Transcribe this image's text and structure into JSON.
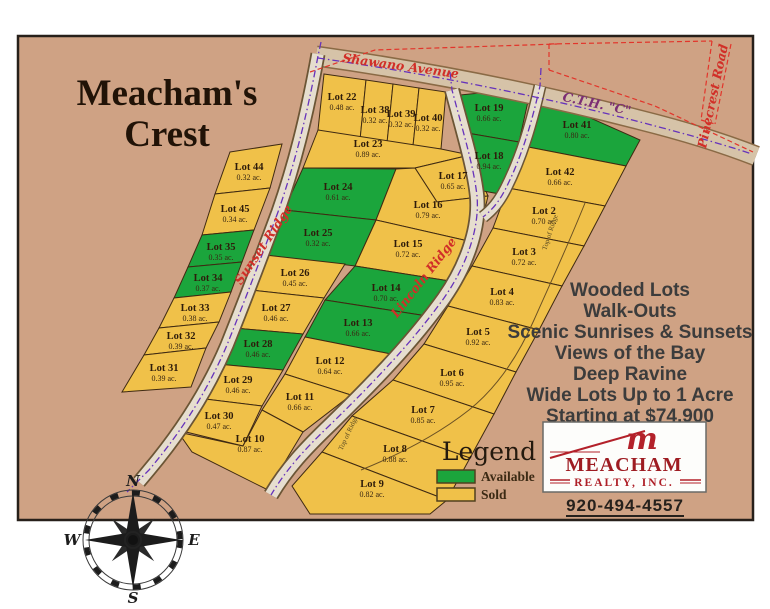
{
  "title": {
    "line1": "Meacham's",
    "line2": "Crest"
  },
  "roads": {
    "shawano": "Shawano Avenue",
    "cth_c": "C.T.H. \"C\"",
    "pinecrest": "Pinecrest Road",
    "sunset": "Sunset Ridge",
    "lincoln": "Lincoln Ridge",
    "top_of_ridge": "Top of Ridge"
  },
  "marketing": {
    "lines": [
      "Wooded Lots",
      "Walk-Outs",
      "Scenic Sunrises & Sunsets",
      "Views of the Bay",
      "Deep Ravine",
      "Wide Lots Up to 1 Acre",
      "Starting at $74,900"
    ]
  },
  "legend": {
    "title": "Legend",
    "items": [
      {
        "label": "Available",
        "color": "#1BA53C"
      },
      {
        "label": "Sold",
        "color": "#F0C149"
      }
    ]
  },
  "realty": {
    "monogram": "m",
    "name": "MEACHAM",
    "subtitle": "REALTY, INC.",
    "phone": "920-494-4557"
  },
  "compass": {
    "north": "N",
    "south": "S",
    "east": "E",
    "west": "W"
  },
  "map_colors": {
    "background": "#CFA284",
    "available": "#1BA53C",
    "sold": "#F0C149"
  },
  "lots": [
    {
      "name": "Lot 44",
      "acreage": "0.32 ac.",
      "status": "sold",
      "color": "#F0C149"
    },
    {
      "name": "Lot 45",
      "acreage": "0.34 ac.",
      "status": "sold",
      "color": "#F0C149"
    },
    {
      "name": "Lot 35",
      "acreage": "0.35 ac.",
      "status": "available",
      "color": "#1BA53C"
    },
    {
      "name": "Lot 34",
      "acreage": "0.37 ac.",
      "status": "available",
      "color": "#1BA53C"
    },
    {
      "name": "Lot 33",
      "acreage": "0.38 ac.",
      "status": "sold",
      "color": "#F0C149"
    },
    {
      "name": "Lot 32",
      "acreage": "0.39 ac.",
      "status": "sold",
      "color": "#F0C149"
    },
    {
      "name": "Lot 31",
      "acreage": "0.39 ac.",
      "status": "sold",
      "color": "#F0C149"
    },
    {
      "name": "Lot 22",
      "acreage": "0.48 ac.",
      "status": "sold",
      "color": "#F0C149"
    },
    {
      "name": "Lot 38",
      "acreage": "0.32 ac.",
      "status": "sold",
      "color": "#F0C149"
    },
    {
      "name": "Lot 39",
      "acreage": "0.32 ac.",
      "status": "sold",
      "color": "#F0C149"
    },
    {
      "name": "Lot 40",
      "acreage": "0.32 ac.",
      "status": "sold",
      "color": "#F0C149"
    },
    {
      "name": "Lot 23",
      "acreage": "0.89 ac.",
      "status": "sold",
      "color": "#F0C149"
    },
    {
      "name": "Lot 17",
      "acreage": "0.65 ac.",
      "status": "sold",
      "color": "#F0C149"
    },
    {
      "name": "Lot 24",
      "acreage": "0.61 ac.",
      "status": "available",
      "color": "#1BA53C"
    },
    {
      "name": "Lot 16",
      "acreage": "0.79 ac.",
      "status": "sold",
      "color": "#F0C149"
    },
    {
      "name": "Lot 15",
      "acreage": "0.72 ac.",
      "status": "sold",
      "color": "#F0C149"
    },
    {
      "name": "Lot 25",
      "acreage": "0.32 ac.",
      "status": "available",
      "color": "#1BA53C"
    },
    {
      "name": "Lot 26",
      "acreage": "0.45 ac.",
      "status": "sold",
      "color": "#F0C149"
    },
    {
      "name": "Lot 27",
      "acreage": "0.46 ac.",
      "status": "sold",
      "color": "#F0C149"
    },
    {
      "name": "Lot 28",
      "acreage": "0.46 ac.",
      "status": "available",
      "color": "#1BA53C"
    },
    {
      "name": "Lot 29",
      "acreage": "0.46 ac.",
      "status": "sold",
      "color": "#F0C149"
    },
    {
      "name": "Lot 30",
      "acreage": "0.47 ac.",
      "status": "sold",
      "color": "#F0C149"
    },
    {
      "name": "Lot 14",
      "acreage": "0.70 ac.",
      "status": "available",
      "color": "#1BA53C"
    },
    {
      "name": "Lot 13",
      "acreage": "0.66 ac.",
      "status": "available",
      "color": "#1BA53C"
    },
    {
      "name": "Lot 12",
      "acreage": "0.64 ac.",
      "status": "sold",
      "color": "#F0C149"
    },
    {
      "name": "Lot 11",
      "acreage": "0.66 ac.",
      "status": "sold",
      "color": "#F0C149"
    },
    {
      "name": "Lot 10",
      "acreage": "0.87 ac.",
      "status": "sold",
      "color": "#F0C149"
    },
    {
      "name": "Lot 19",
      "acreage": "0.66 ac.",
      "status": "available",
      "color": "#1BA53C"
    },
    {
      "name": "Lot 18",
      "acreage": "0.94 ac.",
      "status": "available",
      "color": "#1BA53C"
    },
    {
      "name": "Lot 41",
      "acreage": "0.80 ac.",
      "status": "available",
      "color": "#1BA53C"
    },
    {
      "name": "Lot 42",
      "acreage": "0.66 ac.",
      "status": "sold",
      "color": "#F0C149"
    },
    {
      "name": "Lot 2",
      "acreage": "0.70 ac.",
      "status": "sold",
      "color": "#F0C149"
    },
    {
      "name": "Lot 3",
      "acreage": "0.72 ac.",
      "status": "sold",
      "color": "#F0C149"
    },
    {
      "name": "Lot 4",
      "acreage": "0.83 ac.",
      "status": "sold",
      "color": "#F0C149"
    },
    {
      "name": "Lot 5",
      "acreage": "0.92 ac.",
      "status": "sold",
      "color": "#F0C149"
    },
    {
      "name": "Lot 6",
      "acreage": "0.95 ac.",
      "status": "sold",
      "color": "#F0C149"
    },
    {
      "name": "Lot 7",
      "acreage": "0.85 ac.",
      "status": "sold",
      "color": "#F0C149"
    },
    {
      "name": "Lot 8",
      "acreage": "0.88 ac.",
      "status": "sold",
      "color": "#F0C149"
    },
    {
      "name": "Lot 9",
      "acreage": "0.82 ac.",
      "status": "sold",
      "color": "#F0C149"
    }
  ]
}
